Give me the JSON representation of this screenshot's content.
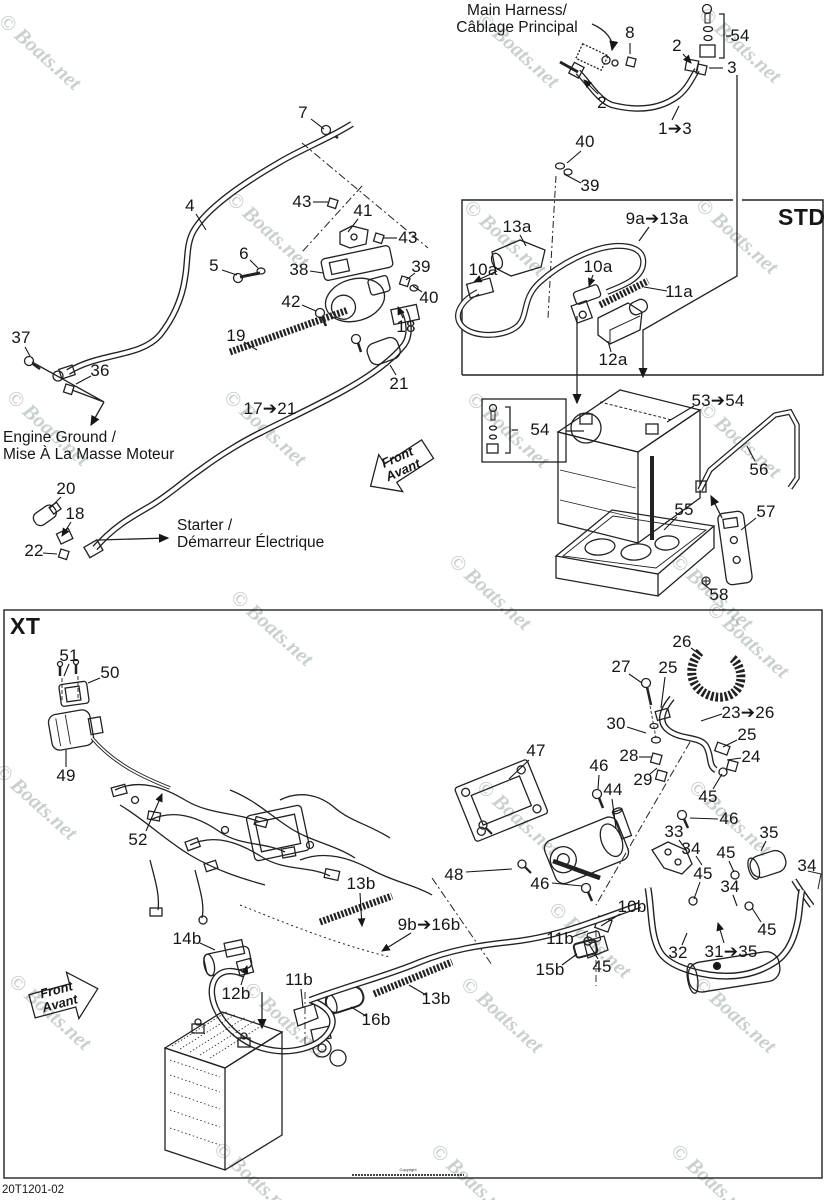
{
  "meta": {
    "std_label": "STD",
    "xt_label": "XT",
    "part_number": "20T1201-02",
    "copyright_line": "Copyright",
    "watermark_text": "© Boats.net"
  },
  "notes": {
    "main_harness": {
      "line1": "Main Harness/",
      "line2": "Câblage Principal"
    },
    "engine_ground": {
      "line1": "Engine Ground /",
      "line2": "Mise À La Masse Moteur"
    },
    "starter": {
      "line1": "Starter /",
      "line2": "Démarreur Électrique"
    },
    "front_arrow": {
      "line1": "Front",
      "line2": "Avant"
    }
  },
  "callouts": [
    {
      "t": "8",
      "x": 630,
      "y": 33,
      "l": [
        630,
        43,
        630,
        54
      ]
    },
    {
      "t": "54",
      "x": 740,
      "y": 36
    },
    {
      "t": "2",
      "x": 677,
      "y": 46,
      "l": [
        683,
        54,
        691,
        63
      ],
      "a": 1
    },
    {
      "t": "3",
      "x": 732,
      "y": 68,
      "l": [
        723,
        68,
        709,
        68
      ]
    },
    {
      "t": "2",
      "x": 602,
      "y": 103,
      "l": [
        598,
        94,
        584,
        80
      ],
      "a": 1
    },
    {
      "t": "1➔3",
      "x": 675,
      "y": 129,
      "l": [
        672,
        120,
        679,
        106
      ]
    },
    {
      "t": "7",
      "x": 303,
      "y": 113,
      "l": [
        311,
        119,
        324,
        129
      ]
    },
    {
      "t": "40",
      "x": 585,
      "y": 142,
      "l": [
        581,
        151,
        567,
        163
      ]
    },
    {
      "t": "39",
      "x": 590,
      "y": 186,
      "l": [
        581,
        183,
        564,
        174
      ]
    },
    {
      "t": "4",
      "x": 190,
      "y": 206,
      "l": [
        196,
        214,
        206,
        230
      ]
    },
    {
      "t": "43",
      "x": 302,
      "y": 202,
      "l": [
        313,
        202,
        328,
        202
      ]
    },
    {
      "t": "41",
      "x": 363,
      "y": 211,
      "l": [
        358,
        219,
        348,
        232
      ]
    },
    {
      "t": "43",
      "x": 408,
      "y": 238,
      "l": [
        397,
        238,
        383,
        238
      ]
    },
    {
      "t": "5",
      "x": 214,
      "y": 266,
      "l": [
        222,
        270,
        237,
        275
      ]
    },
    {
      "t": "6",
      "x": 244,
      "y": 254,
      "l": [
        250,
        260,
        258,
        268
      ]
    },
    {
      "t": "38",
      "x": 299,
      "y": 270,
      "l": [
        310,
        271,
        323,
        273
      ]
    },
    {
      "t": "39",
      "x": 421,
      "y": 267,
      "l": [
        415,
        273,
        406,
        280
      ]
    },
    {
      "t": "42",
      "x": 291,
      "y": 302,
      "l": [
        302,
        305,
        316,
        311
      ]
    },
    {
      "t": "40",
      "x": 429,
      "y": 298,
      "l": [
        422,
        292,
        413,
        286
      ]
    },
    {
      "t": "18",
      "x": 406,
      "y": 327,
      "l": [
        403,
        318,
        398,
        307
      ],
      "a": 1
    },
    {
      "t": "19",
      "x": 236,
      "y": 336,
      "l": [
        244,
        342,
        257,
        350
      ]
    },
    {
      "t": "21",
      "x": 399,
      "y": 384,
      "l": [
        396,
        375,
        390,
        365
      ]
    },
    {
      "t": "17➔21",
      "x": 270,
      "y": 409
    },
    {
      "t": "37",
      "x": 21,
      "y": 338,
      "l": [
        25,
        347,
        30,
        356
      ]
    },
    {
      "t": "36",
      "x": 100,
      "y": 371,
      "l": [
        91,
        376,
        76,
        384
      ]
    },
    {
      "t": "20",
      "x": 66,
      "y": 489,
      "l": [
        61,
        497,
        50,
        508
      ]
    },
    {
      "t": "18",
      "x": 75,
      "y": 514,
      "l": [
        71,
        522,
        62,
        536
      ],
      "a": 1
    },
    {
      "t": "22",
      "x": 34,
      "y": 551,
      "l": [
        43,
        553,
        57,
        554
      ]
    },
    {
      "t": "13a",
      "x": 517,
      "y": 227,
      "l": [
        520,
        235,
        526,
        246
      ]
    },
    {
      "t": "9a➔13a",
      "x": 657,
      "y": 219,
      "l": [
        649,
        227,
        639,
        241
      ]
    },
    {
      "t": "10a",
      "x": 483,
      "y": 270,
      "l": [
        497,
        271,
        474,
        282
      ],
      "a": 1
    },
    {
      "t": "10a",
      "x": 598,
      "y": 267,
      "l": [
        593,
        275,
        589,
        286
      ],
      "a": 1
    },
    {
      "t": "11a",
      "x": 679,
      "y": 292,
      "l": [
        667,
        291,
        644,
        287
      ]
    },
    {
      "t": "12a",
      "x": 613,
      "y": 360,
      "l": [
        611,
        352,
        608,
        341
      ]
    },
    {
      "t": "54",
      "x": 540,
      "y": 430
    },
    {
      "t": "53➔54",
      "x": 718,
      "y": 401,
      "l": [
        694,
        406,
        667,
        422
      ]
    },
    {
      "t": "56",
      "x": 759,
      "y": 470,
      "l": [
        755,
        461,
        747,
        446
      ]
    },
    {
      "t": "55",
      "x": 684,
      "y": 510,
      "l": [
        677,
        517,
        664,
        530
      ]
    },
    {
      "t": "57",
      "x": 766,
      "y": 512,
      "l": [
        756,
        518,
        741,
        530
      ]
    },
    {
      "t": "58",
      "x": 719,
      "y": 595,
      "l": [
        711,
        590,
        702,
        583
      ]
    },
    {
      "t": "51",
      "x": 69,
      "y": 656,
      "l": [
        69,
        664,
        64,
        676
      ]
    },
    {
      "t": "50",
      "x": 110,
      "y": 673,
      "l": [
        100,
        678,
        88,
        683
      ]
    },
    {
      "t": "49",
      "x": 66,
      "y": 776,
      "l": [
        66,
        767,
        66,
        750
      ]
    },
    {
      "t": "52",
      "x": 138,
      "y": 840,
      "l": [
        146,
        831,
        162,
        794
      ],
      "a": 1
    },
    {
      "t": "26",
      "x": 682,
      "y": 642,
      "l": [
        691,
        648,
        702,
        656
      ]
    },
    {
      "t": "27",
      "x": 621,
      "y": 667,
      "l": [
        629,
        674,
        642,
        683
      ]
    },
    {
      "t": "25",
      "x": 668,
      "y": 668,
      "l": [
        665,
        677,
        661,
        708
      ]
    },
    {
      "t": "30",
      "x": 616,
      "y": 724,
      "l": [
        627,
        727,
        646,
        733
      ]
    },
    {
      "t": "23➔26",
      "x": 748,
      "y": 713,
      "l": [
        722,
        714,
        701,
        721
      ]
    },
    {
      "t": "25",
      "x": 747,
      "y": 735,
      "l": [
        737,
        740,
        723,
        747
      ]
    },
    {
      "t": "28",
      "x": 629,
      "y": 756,
      "l": [
        639,
        757,
        652,
        757
      ]
    },
    {
      "t": "24",
      "x": 751,
      "y": 757,
      "l": [
        741,
        758,
        727,
        760
      ]
    },
    {
      "t": "29",
      "x": 643,
      "y": 780,
      "l": [
        650,
        774,
        657,
        768
      ]
    },
    {
      "t": "47",
      "x": 536,
      "y": 751,
      "l": [
        529,
        760,
        509,
        779
      ]
    },
    {
      "t": "46",
      "x": 599,
      "y": 766,
      "l": [
        599,
        775,
        598,
        789
      ]
    },
    {
      "t": "44",
      "x": 613,
      "y": 790,
      "l": [
        612,
        799,
        616,
        828
      ]
    },
    {
      "t": "45",
      "x": 708,
      "y": 797,
      "l": [
        713,
        789,
        722,
        774
      ]
    },
    {
      "t": "46",
      "x": 729,
      "y": 819,
      "l": [
        718,
        819,
        690,
        818
      ]
    },
    {
      "t": "33",
      "x": 674,
      "y": 832,
      "l": [
        679,
        840,
        687,
        851
      ]
    },
    {
      "t": "35",
      "x": 769,
      "y": 833,
      "l": [
        766,
        841,
        761,
        851
      ]
    },
    {
      "t": "34",
      "x": 691,
      "y": 849,
      "l": [
        696,
        856,
        702,
        865
      ]
    },
    {
      "t": "45",
      "x": 726,
      "y": 853,
      "l": [
        729,
        861,
        734,
        872
      ]
    },
    {
      "t": "34",
      "x": 807,
      "y": 866
    },
    {
      "t": "45",
      "x": 703,
      "y": 874,
      "l": [
        700,
        882,
        694,
        899
      ]
    },
    {
      "t": "34",
      "x": 730,
      "y": 887,
      "l": [
        733,
        895,
        737,
        906
      ]
    },
    {
      "t": "48",
      "x": 454,
      "y": 875,
      "l": [
        466,
        872,
        512,
        869
      ]
    },
    {
      "t": "46",
      "x": 540,
      "y": 884,
      "l": [
        552,
        883,
        582,
        886
      ]
    },
    {
      "t": "13b",
      "x": 361,
      "y": 884,
      "l": [
        360,
        893,
        362,
        926
      ],
      "a": 1
    },
    {
      "t": "9b➔16b",
      "x": 429,
      "y": 925,
      "l": [
        411,
        933,
        382,
        951
      ],
      "a": 1
    },
    {
      "t": "10b",
      "x": 632,
      "y": 907,
      "l": [
        620,
        914,
        601,
        926
      ]
    },
    {
      "t": "45",
      "x": 767,
      "y": 930,
      "l": [
        761,
        922,
        752,
        908
      ]
    },
    {
      "t": "14b",
      "x": 187,
      "y": 939,
      "l": [
        200,
        943,
        215,
        950
      ]
    },
    {
      "t": "11b",
      "x": 560,
      "y": 939,
      "l": [
        572,
        937,
        588,
        931
      ]
    },
    {
      "t": "32",
      "x": 678,
      "y": 953,
      "l": [
        682,
        945,
        687,
        933
      ]
    },
    {
      "t": "31➔35",
      "x": 731,
      "y": 952,
      "l": [
        724,
        943,
        718,
        923
      ],
      "a": 1
    },
    {
      "t": "15b",
      "x": 550,
      "y": 970,
      "l": [
        562,
        965,
        577,
        954
      ]
    },
    {
      "t": "45",
      "x": 602,
      "y": 967,
      "l": [
        598,
        959,
        589,
        944
      ]
    },
    {
      "t": "11b",
      "x": 299,
      "y": 980,
      "l": [
        301,
        989,
        303,
        1008
      ]
    },
    {
      "t": "12b",
      "x": 236,
      "y": 994,
      "l": [
        241,
        985,
        247,
        966
      ],
      "a": 1
    },
    {
      "t": "13b",
      "x": 436,
      "y": 999,
      "l": [
        426,
        995,
        409,
        985
      ]
    },
    {
      "t": "16b",
      "x": 376,
      "y": 1020,
      "l": [
        366,
        1016,
        351,
        1007
      ]
    }
  ],
  "watermarks": [
    [
      40,
      52
    ],
    [
      518,
      50
    ],
    [
      740,
      45
    ],
    [
      268,
      230
    ],
    [
      505,
      238
    ],
    [
      737,
      236
    ],
    [
      48,
      428
    ],
    [
      265,
      428
    ],
    [
      508,
      430
    ],
    [
      740,
      440
    ],
    [
      490,
      592
    ],
    [
      712,
      592
    ],
    [
      272,
      628
    ],
    [
      748,
      640
    ],
    [
      36,
      802
    ],
    [
      518,
      818
    ],
    [
      730,
      818
    ],
    [
      590,
      940
    ],
    [
      50,
      1012
    ],
    [
      285,
      1020
    ],
    [
      502,
      1015
    ],
    [
      735,
      1015
    ],
    [
      255,
      1180
    ],
    [
      472,
      1182
    ],
    [
      712,
      1182
    ]
  ]
}
